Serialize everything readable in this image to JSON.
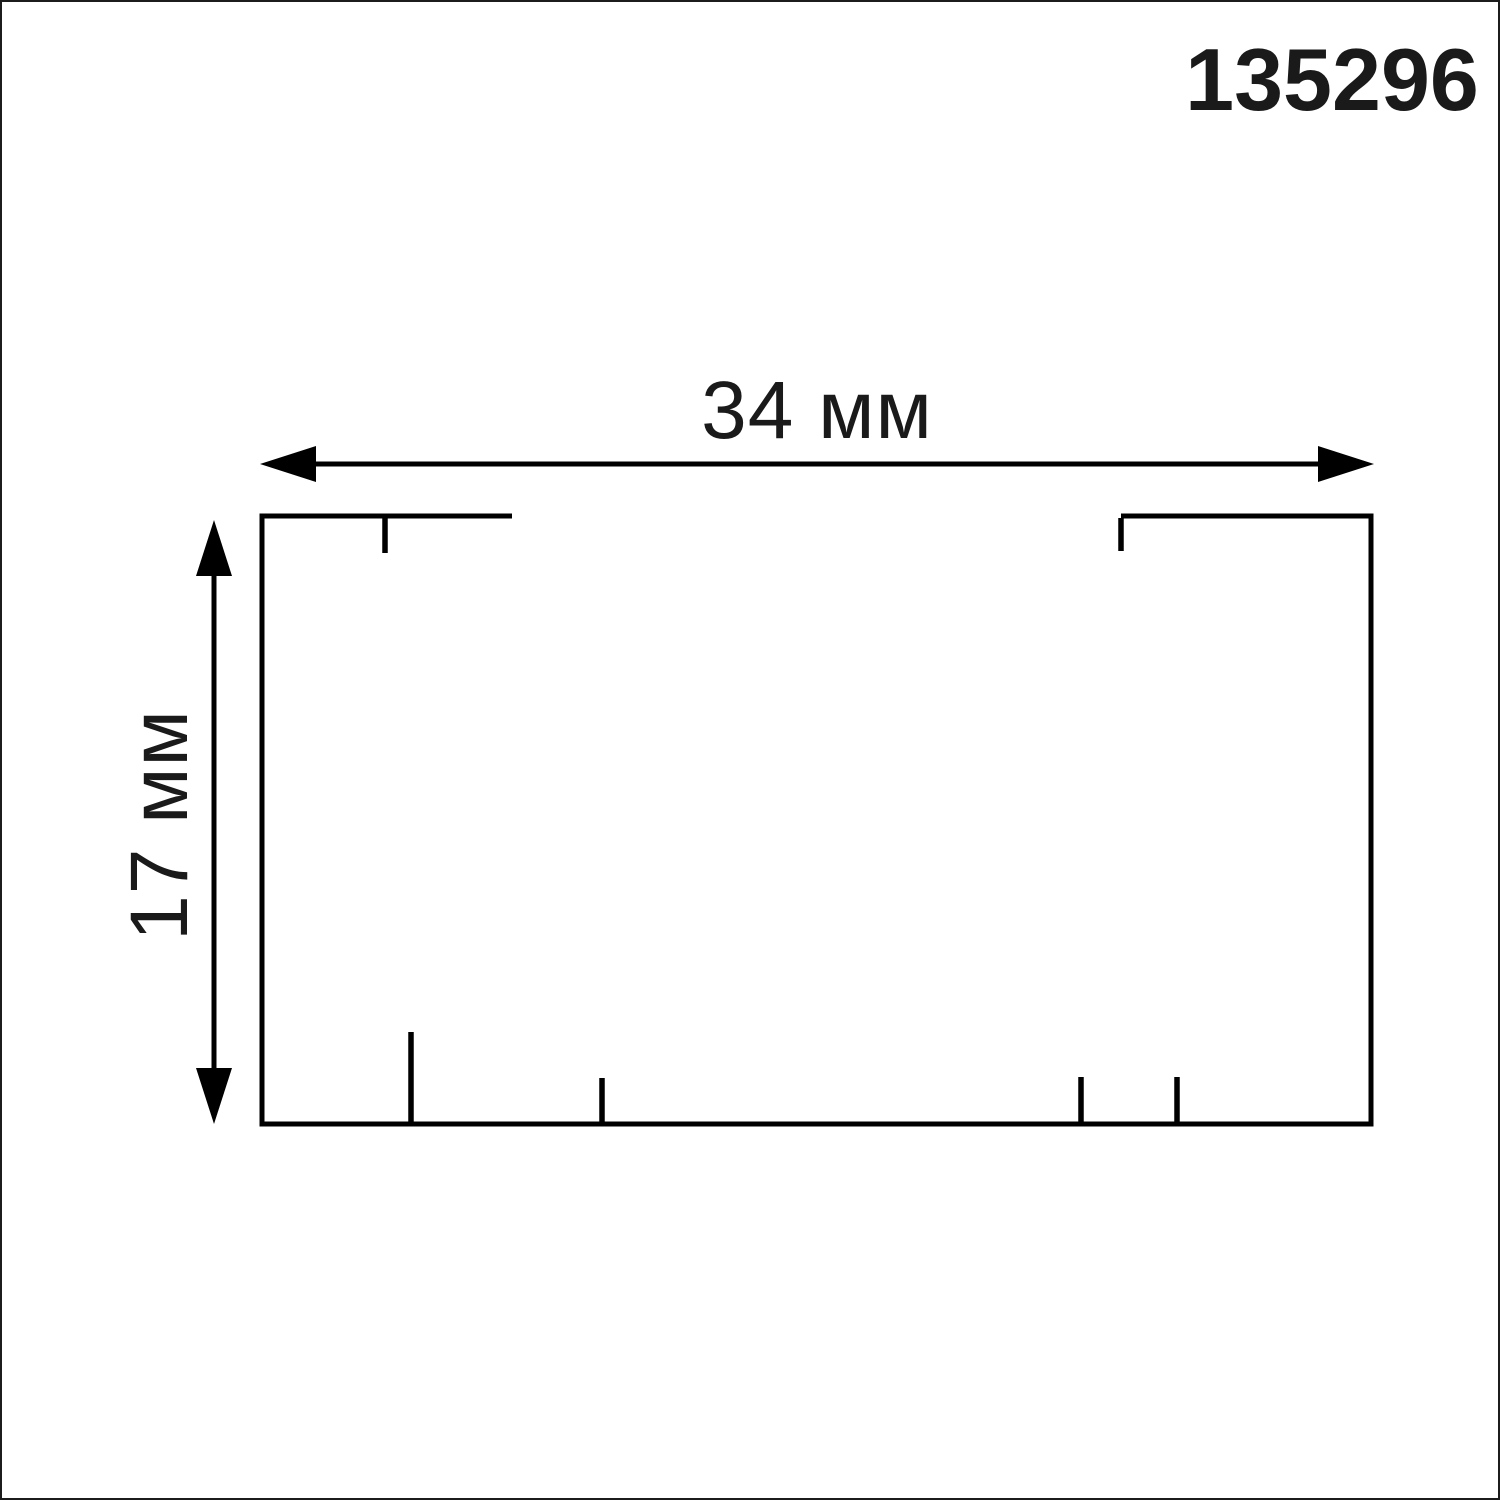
{
  "page": {
    "background_color": "#ffffff",
    "border_color": "#1c1c1c",
    "line_color": "#000000",
    "text_color": "#1a1a1a"
  },
  "part_number": "135296",
  "dimensions": {
    "width": {
      "label": "34 мм"
    },
    "height": {
      "label": "17 мм"
    }
  }
}
